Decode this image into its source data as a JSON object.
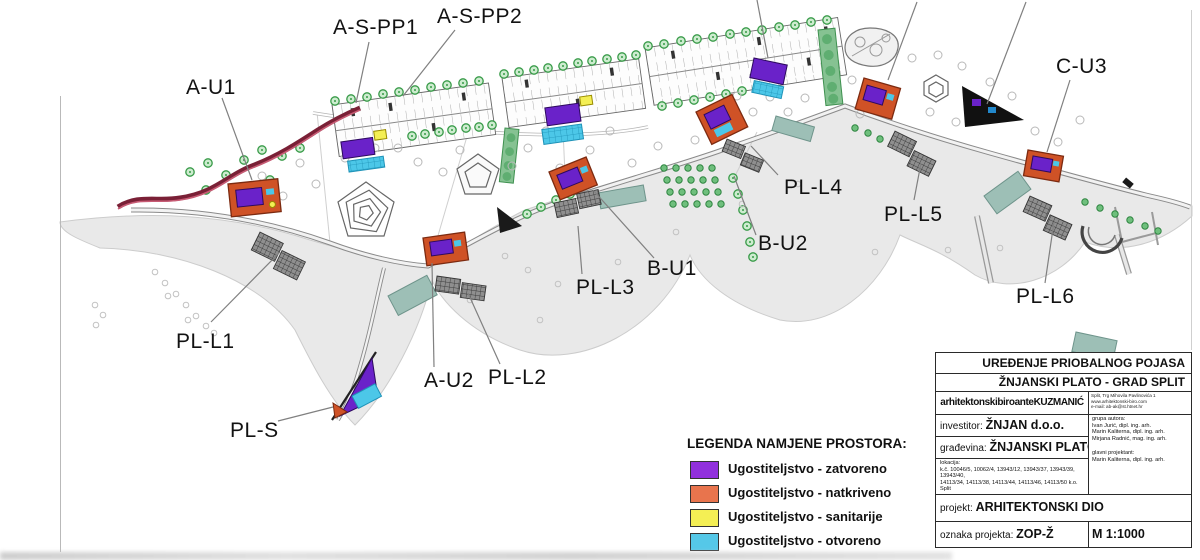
{
  "map": {
    "labels": [
      {
        "id": "a-u1",
        "text": "A-U1"
      },
      {
        "id": "a-s-pp1",
        "text": "A-S-PP1"
      },
      {
        "id": "a-s-pp2",
        "text": "A-S-PP2"
      },
      {
        "id": "c-u3",
        "text": "C-U3"
      },
      {
        "id": "pl-l4",
        "text": "PL-L4"
      },
      {
        "id": "pl-l5",
        "text": "PL-L5"
      },
      {
        "id": "b-u2",
        "text": "B-U2"
      },
      {
        "id": "b-u1",
        "text": "B-U1"
      },
      {
        "id": "pl-l3",
        "text": "PL-L3"
      },
      {
        "id": "pl-l6",
        "text": "PL-L6"
      },
      {
        "id": "pl-l1",
        "text": "PL-L1"
      },
      {
        "id": "a-u2",
        "text": "A-U2"
      },
      {
        "id": "pl-l2",
        "text": "PL-L2"
      },
      {
        "id": "pl-s",
        "text": "PL-S"
      }
    ],
    "legend": {
      "title": "LEGENDA NAMJENE PROSTORA:",
      "items": [
        {
          "label": "Ugostiteljstvo - zatvoreno",
          "color": "#9130dd"
        },
        {
          "label": "Ugostiteljstvo - natkriveno",
          "color": "#e8744d"
        },
        {
          "label": "Ugostiteljstvo - sanitarije",
          "color": "#f4ef54"
        },
        {
          "label": "Ugostiteljstvo - otvoreno",
          "color": "#55c8e8"
        }
      ]
    }
  },
  "title_block": {
    "row1": "UREĐENJE PRIOBALNOG POJASA",
    "row2": "ŽNJANSKI PLATO - GRAD SPLIT",
    "firm": "arhitektonskibiroanteKUZMANIĆ",
    "firm_address": "Split, Trg Mihovila Pavlinovića 1\nwww.arhitektonski-biro.com\ne-mail: ab-ak@st.htnet.hr",
    "investor_line": "investitor:",
    "investor": "ŽNJAN d.o.o.",
    "building_line": "građevina:",
    "building": "ŽNJANSKI PLATO",
    "location_label": "lokacija:",
    "location_line1": "k.č. 10046/5, 10062/4, 13943/12, 13943/37, 13943/39, 13943/40,",
    "location_line2": "14113/34, 14113/38, 14113/44, 14113/46, 14113/50 k.o. Split",
    "authors_label": "grupa autora:",
    "author1": "Ivan Jurić, dipl. ing. arh.",
    "author2": "Marin Kaliterna, dipl. ing. arh.",
    "author3": "Mirjana Radnić, mag. ing. arh.",
    "lead_label": "glavni projektant:",
    "lead": "Marin Kaliterna, dipl. ing. arh.",
    "project_label": "projekt:",
    "project": "ARHITEKTONSKI DIO",
    "code_label": "oznaka projekta:",
    "code": "ZOP-Ž",
    "scale": "M 1:1000"
  },
  "colors": {
    "legend_zatvoreno": "#9130dd",
    "legend_natkriveno": "#e8744d",
    "legend_sanitarije": "#f4ef54",
    "legend_otvoreno": "#55c8e8",
    "building_orange": "#cf5226",
    "building_purple": "#6a22c9",
    "road_maroon": "#7a2036"
  }
}
